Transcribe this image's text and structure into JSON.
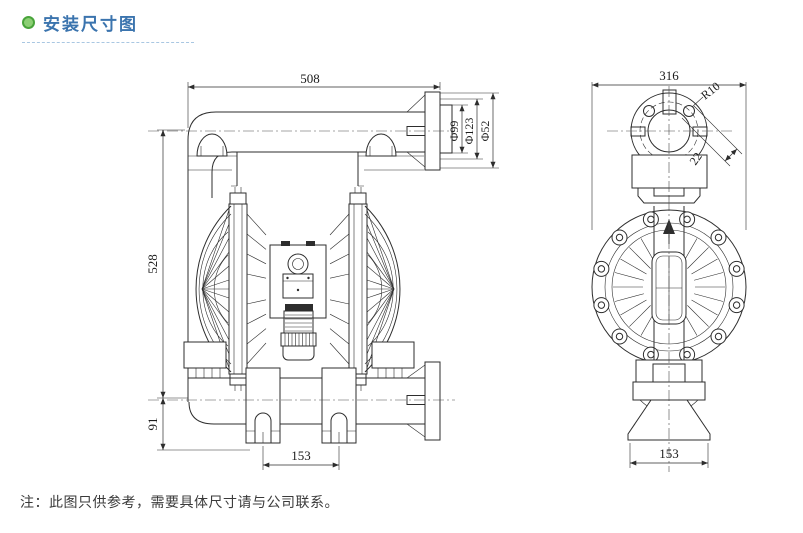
{
  "header": {
    "title": "安装尺寸图"
  },
  "footer": {
    "note": "注：此图只供参考，需要具体尺寸请与公司联系。"
  },
  "colors": {
    "title_blue": "#3b74ae",
    "bullet_green": "#49a43b",
    "line": "#2d2d2d"
  },
  "front_view": {
    "dim_width": "508",
    "dim_height": "528",
    "dim_base_height": "91",
    "dim_foot_spacing": "153",
    "dim_flange_face": "Φ99",
    "dim_flange_bolt_circle": "Φ123",
    "dim_flange_bore": "Φ52"
  },
  "side_view": {
    "dim_depth": "316",
    "dim_hole_radius": "R10",
    "dim_tab": "22",
    "dim_foot_width": "153"
  }
}
